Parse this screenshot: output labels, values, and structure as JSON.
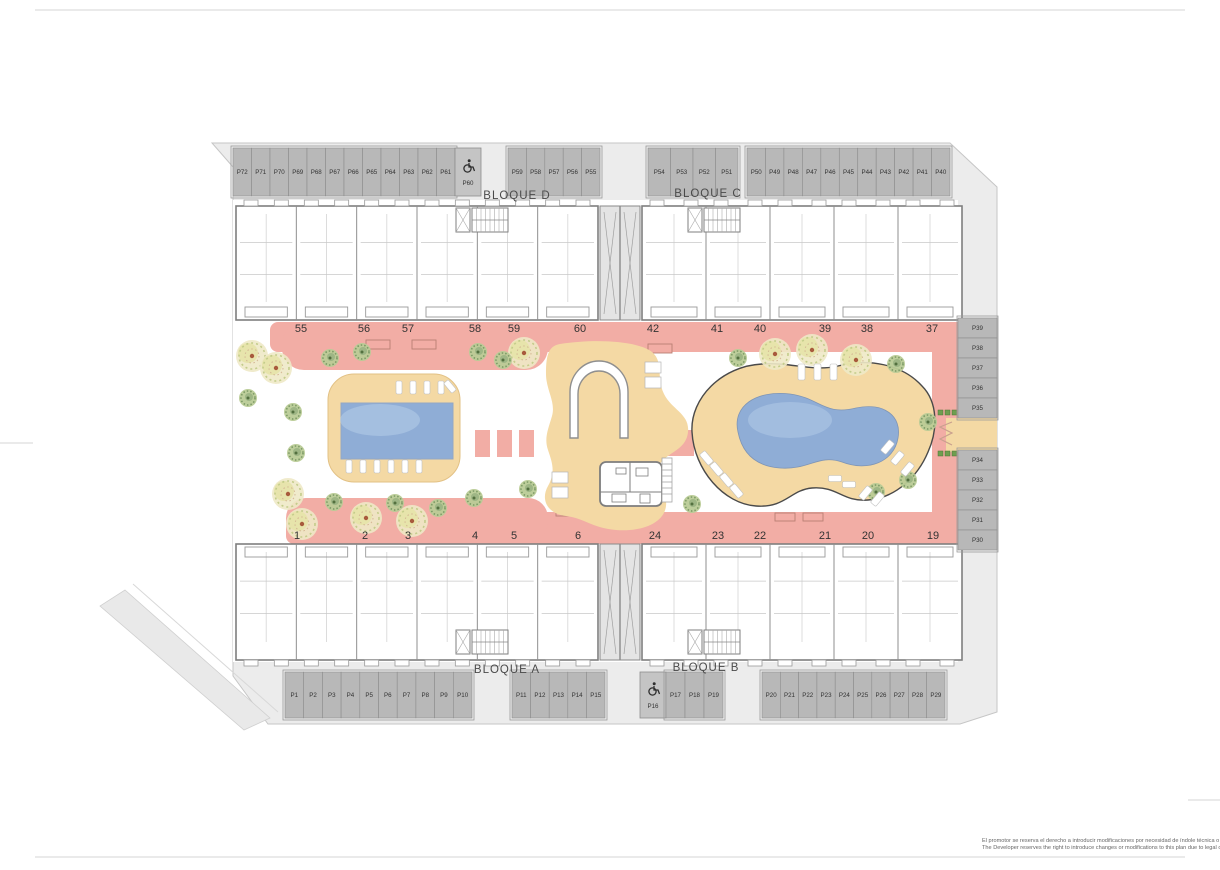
{
  "blocks": {
    "d": "BLOQUE D",
    "c": "BLOQUE C",
    "a": "BLOQUE A",
    "b": "BLOQUE B"
  },
  "parking": {
    "top_left": [
      "P72",
      "P71",
      "P70",
      "P69",
      "P68",
      "P67",
      "P66",
      "P65",
      "P64",
      "P63",
      "P62",
      "P61"
    ],
    "top_left_disabled": "P60",
    "top_mid_d": [
      "P59",
      "P58",
      "P57",
      "P56",
      "P55"
    ],
    "top_mid_c": [
      "P54",
      "P53",
      "P52",
      "P51"
    ],
    "top_right": [
      "P50",
      "P49",
      "P48",
      "P47",
      "P46",
      "P45",
      "P44",
      "P43",
      "P42",
      "P41",
      "P40"
    ],
    "right_upper": [
      "P39",
      "P38",
      "P37",
      "P36",
      "P35"
    ],
    "right_lower": [
      "P34",
      "P33",
      "P32",
      "P31",
      "P30"
    ],
    "bottom_left": [
      "P1",
      "P2",
      "P3",
      "P4",
      "P5",
      "P6",
      "P7",
      "P8",
      "P9",
      "P10"
    ],
    "bottom_mid_a": [
      "P11",
      "P12",
      "P13",
      "P14",
      "P15"
    ],
    "bottom_disabled": "P16",
    "bottom_mid_b": [
      "P17",
      "P18",
      "P19"
    ],
    "bottom_right": [
      "P20",
      "P21",
      "P22",
      "P23",
      "P24",
      "P25",
      "P26",
      "P27",
      "P28",
      "P29"
    ]
  },
  "units": {
    "top_left": [
      "55",
      "56",
      "57",
      "58",
      "59",
      "60"
    ],
    "top_right": [
      "42",
      "41",
      "40",
      "39",
      "38",
      "37"
    ],
    "bottom_left": [
      "1",
      "2",
      "3",
      "4",
      "5",
      "6"
    ],
    "bottom_right": [
      "24",
      "23",
      "22",
      "21",
      "20",
      "19"
    ]
  },
  "disclaimer": {
    "es": "El promotor se reserva el derecho a introducir modificaciones por necesidad de índole técnica o legal o jurídica.",
    "en": "The Developer reserves the right to introduce changes or modifications to this plan due to legal or technical reasons."
  },
  "colors": {
    "site_gray": "#ececec",
    "stall_gray": "#b8b8b8",
    "walk_pink": "#f2ada5",
    "deck_tan": "#f4d9a4",
    "pool_blue": "#8fadd6",
    "pool_highlight": "#bad1ea",
    "wall_gray": "#7f7f7f",
    "tree_big": "#ece5b4",
    "tree_bush": "#b9cb96",
    "hedge_green": "#6f9e4f"
  }
}
